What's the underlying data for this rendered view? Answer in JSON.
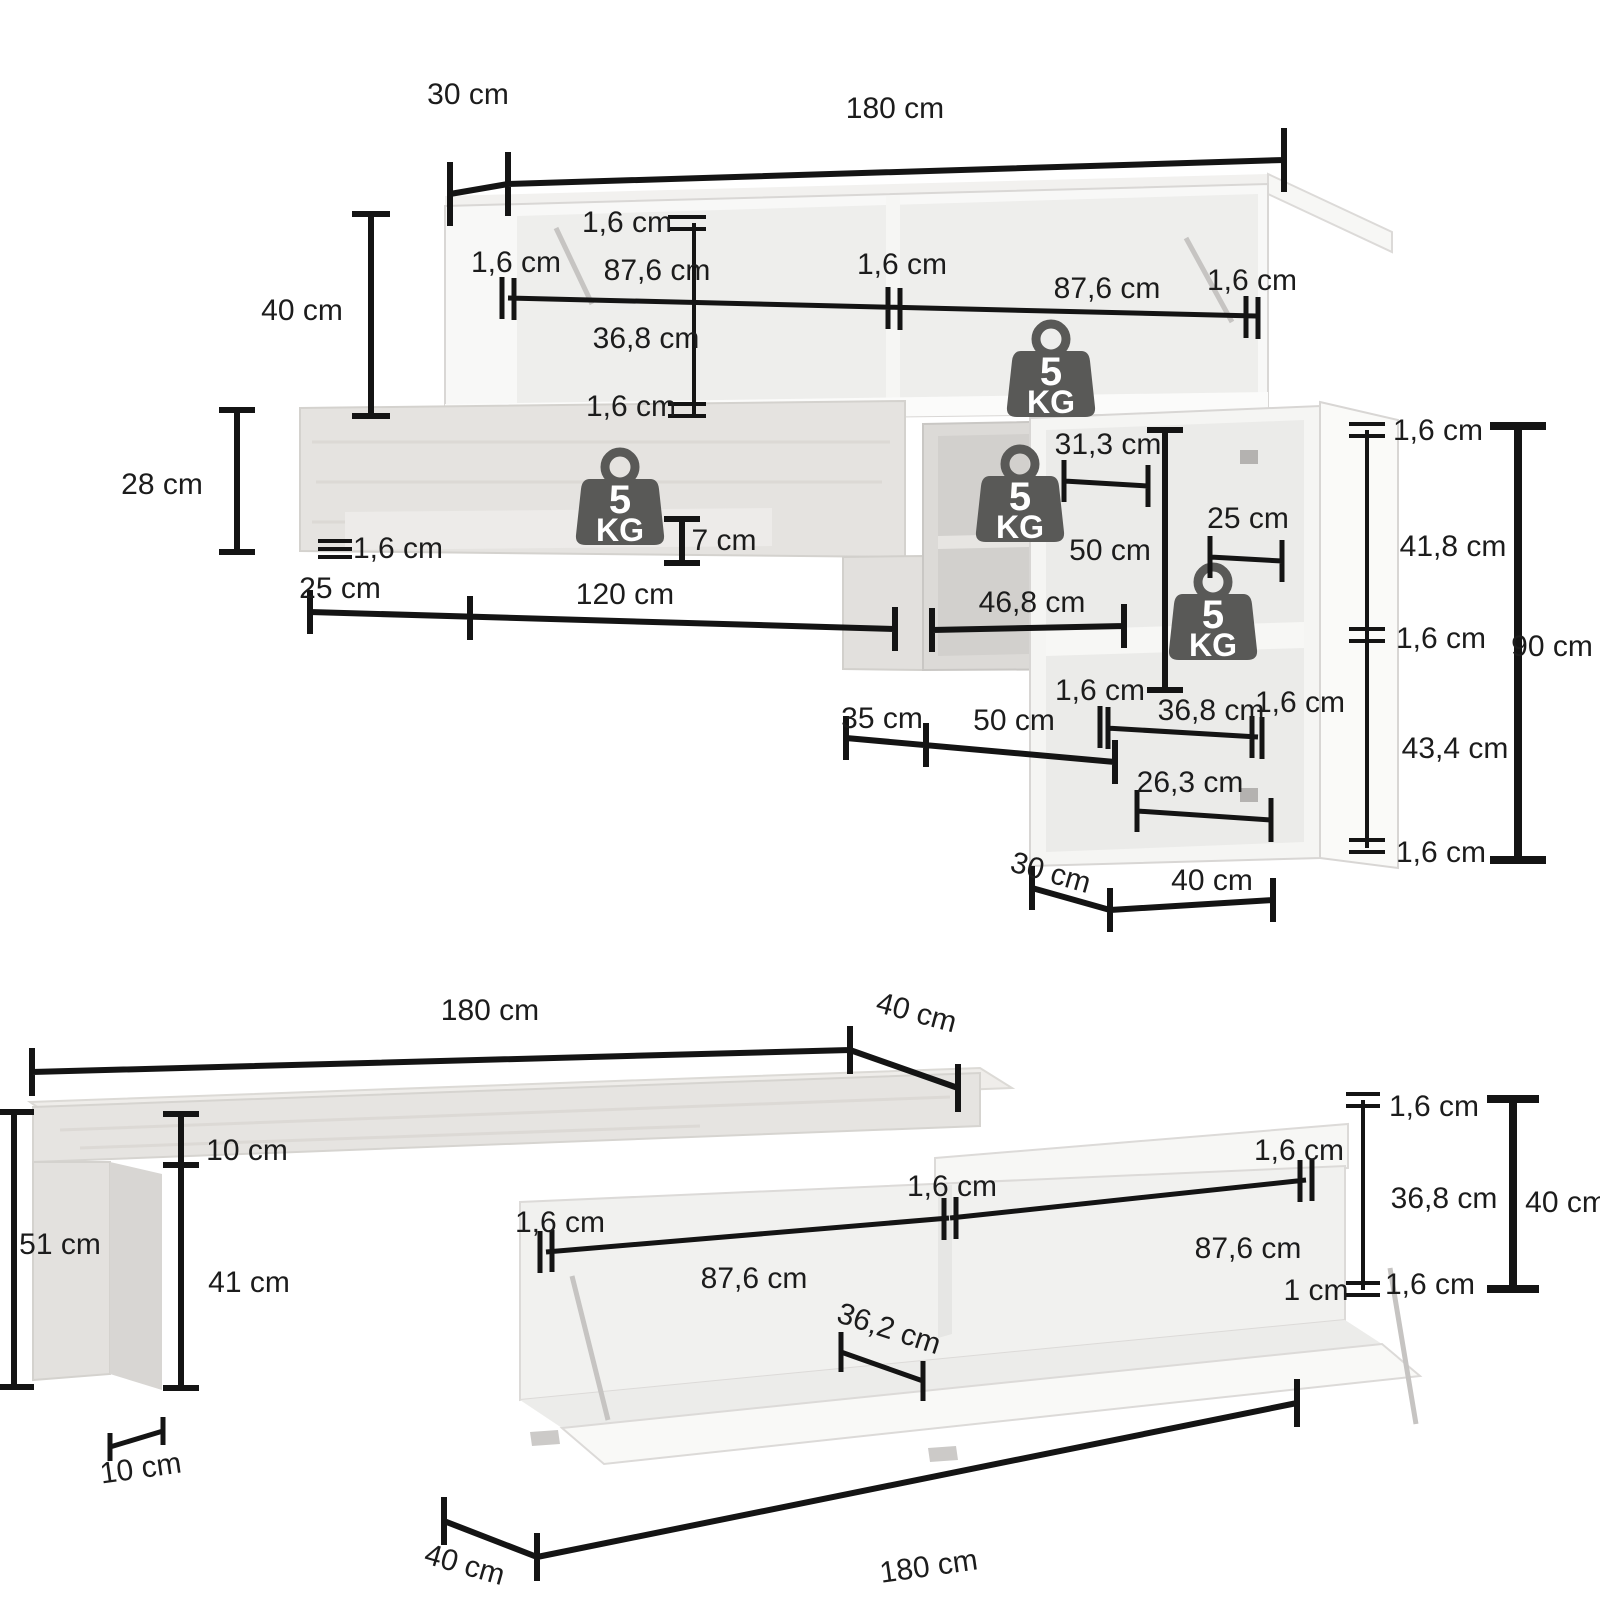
{
  "page": {
    "background": "#ffffff",
    "description_visible_text_only": true
  },
  "shared": {
    "weight_badge": {
      "value": "5",
      "unit": "KG",
      "color": "#595957",
      "text_color": "#ffffff"
    },
    "line_color": "#141414",
    "text_color": "#1c1c1c"
  },
  "top_diagram": {
    "labels": {
      "depth_top": "30 cm",
      "width_total": "180 cm",
      "height_upper_cabinet": "40 cm",
      "height_wall_shelf": "28 cm",
      "panel_thickness": "1,6 cm",
      "compartment_width": "87,6 cm",
      "compartment_height": "36,8 cm",
      "shelf_lip_height": "7 cm",
      "shelf_offset_left": "25 cm",
      "shelf_width": "120 cm",
      "mid_cabinet_inner_width": "31,3 cm",
      "mid_cabinet_height": "50 cm",
      "mid_cabinet_inner_width_full": "46,8 cm",
      "right_cabinet_shelf_width": "25 cm",
      "right_cabinet_upper_inner_height": "41,8 cm",
      "right_cabinet_lower_inner_height": "43,4 cm",
      "right_cabinet_total_height": "90 cm",
      "door_inner_width": "36,8 cm",
      "door_shelf_width": "26,3 cm",
      "offset_35": "35 cm",
      "offset_50": "50 cm",
      "right_cabinet_depth": "30 cm",
      "right_cabinet_width": "40 cm"
    }
  },
  "bottom_diagram": {
    "labels": {
      "width_total": "180 cm",
      "depth_top": "40 cm",
      "bench_height": "51 cm",
      "beam_thickness": "10 cm",
      "leg_clearance_height": "41 cm",
      "leg_depth": "10 cm",
      "panel_thickness": "1,6 cm",
      "compartment_width": "87,6 cm",
      "niche_width": "36,2 cm",
      "compartment_height": "36,8 cm",
      "cabinet_height": "40 cm",
      "base_gap": "1 cm",
      "width_bottom": "180 cm",
      "depth_bottom": "40 cm"
    }
  }
}
